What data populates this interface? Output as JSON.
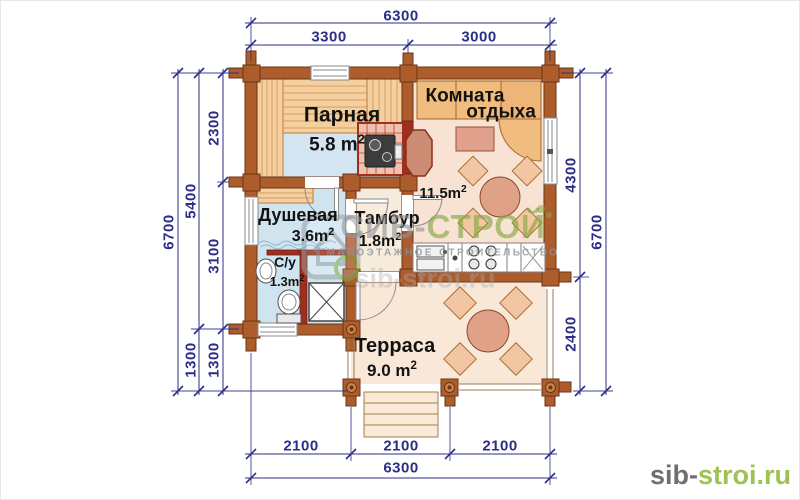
{
  "plan": {
    "rooms": {
      "parnaya": {
        "name": "Парная",
        "area": "5.8 m",
        "area_sup": "2"
      },
      "komnata": {
        "name_line1": "Комната",
        "name_line2": "отдыха",
        "area": "11.5m",
        "area_sup": "2"
      },
      "dushevaya": {
        "name": "Душевая",
        "area": "3.6m",
        "area_sup": "2"
      },
      "tambur": {
        "name": "Тамбур",
        "area": "1.8m",
        "area_sup": "2"
      },
      "su": {
        "name": "С/у",
        "area": "1.3m",
        "area_sup": "2"
      },
      "terrasa": {
        "name": "Терраса",
        "area": "9.0 m",
        "area_sup": "2"
      }
    },
    "dimensions": {
      "top_overall": "6300",
      "top_left": "3300",
      "top_right": "3000",
      "left_outer": "6700",
      "left_mid_upper": "5400",
      "left_mid_lower": "1300",
      "left_inner_upper": "2300",
      "left_inner_middle": "3100",
      "left_inner_lower": "1300",
      "right_inner_upper": "4300",
      "right_inner_lower": "2400",
      "right_outer": "6700",
      "bottom_left": "2100",
      "bottom_middle": "2100",
      "bottom_right": "2100",
      "bottom_overall": "6300"
    }
  },
  "watermark": {
    "brand_gray": "СИБ-",
    "brand_green": "СТРОЙ",
    "tagline": "МАЛОЭТАЖНОЕ СТРОИТЕЛЬСТВО",
    "url": "sib-stroi.ru"
  },
  "logo": {
    "gray": "sib-",
    "green": "stroi.ru"
  },
  "colors": {
    "dimension": "#2b2d86",
    "wall": "#ad5c2c",
    "stove_red": "#9e2f1d",
    "accent_green": "#9cc353",
    "floor_blue": "#d3e5f0",
    "floor_peach": "#f9e7d8"
  }
}
